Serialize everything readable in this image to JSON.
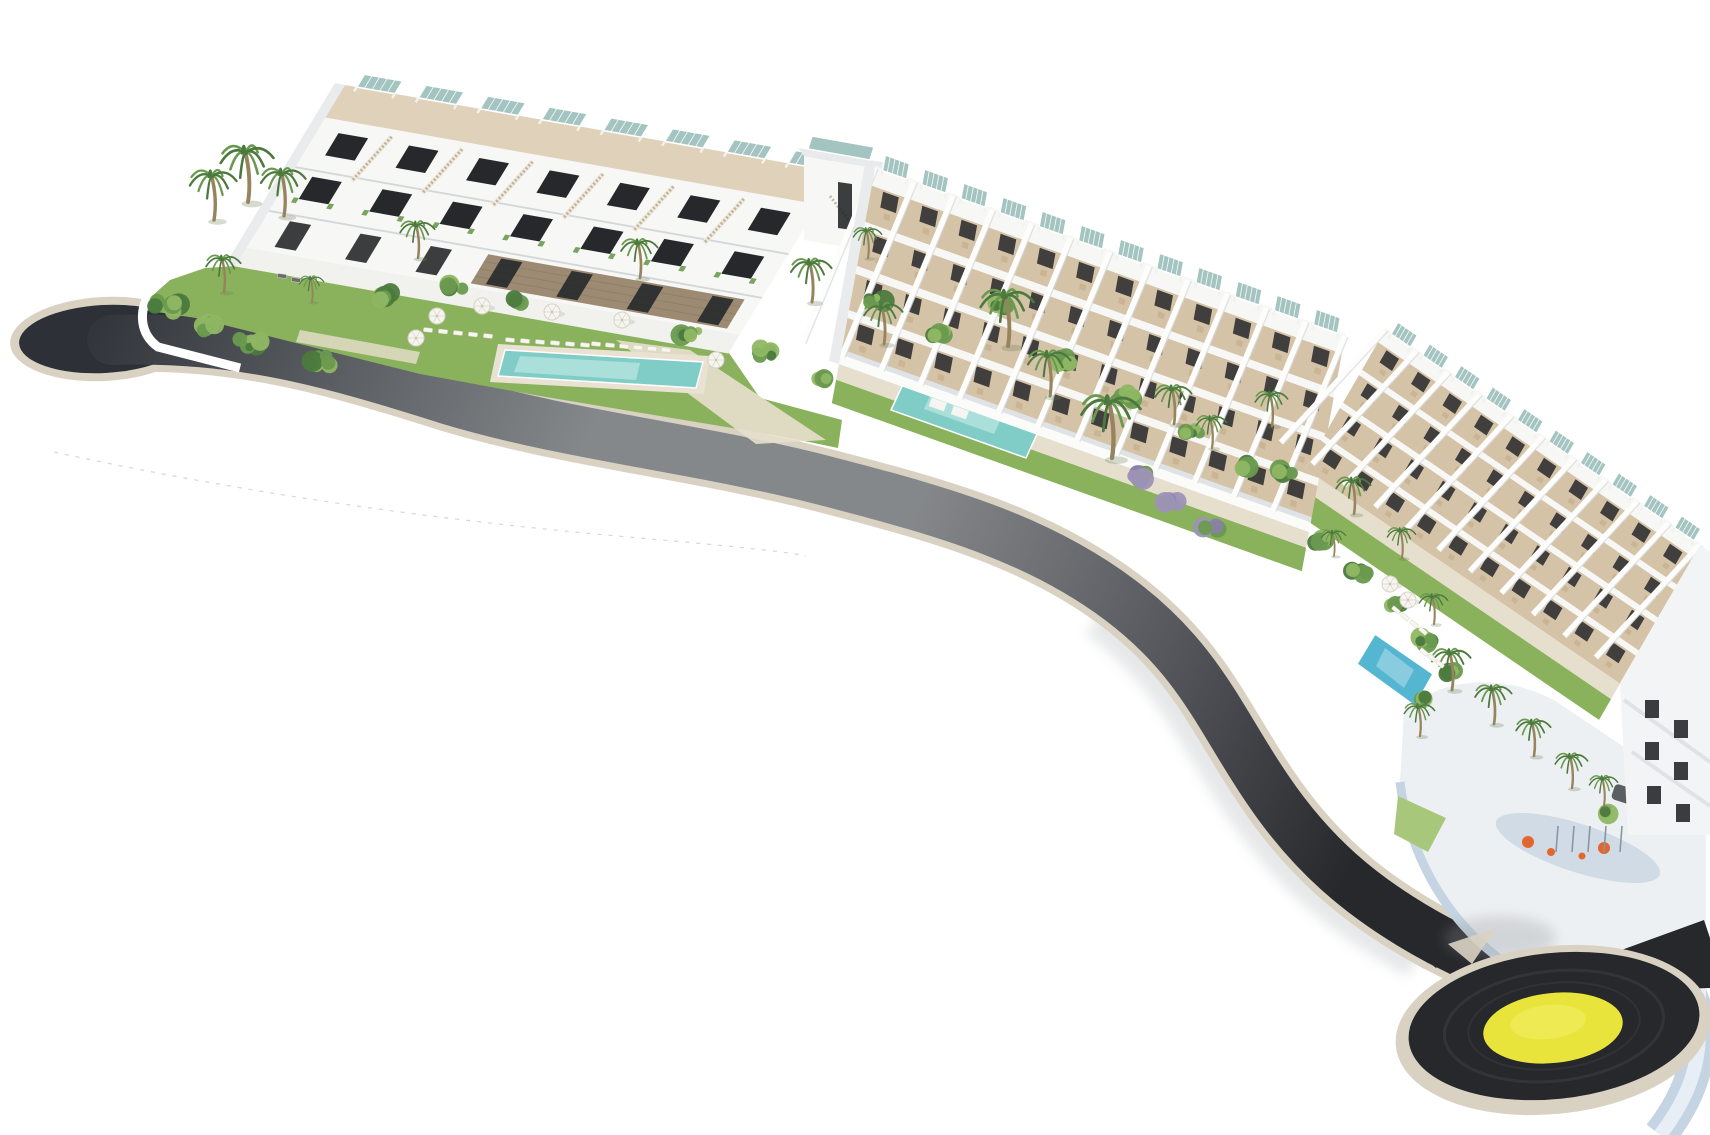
{
  "scene": {
    "type": "aerial-architectural-render",
    "subject": "terraced-white-apartment-complex-with-pools-palms-curved-road-and-roundabout",
    "background": "#ffffff"
  },
  "colors": {
    "background": "#ffffff",
    "road_asphalt_dark": "#2d3036",
    "road_asphalt_mid": "#85888b",
    "road_asphalt_deep": "#27282c",
    "road_curb": "#d9d2c3",
    "roundabout_yellow": "#e9e43c",
    "roundabout_yellow_light": "#f3ef67",
    "pool_turquoise": "#7fcdc6",
    "pool_turquoise_light": "#bde8e2",
    "pool_blue": "#55b6d2",
    "lawn": "#8ab25c",
    "lawn_light": "#a7c77a",
    "foliage_dark": "#4c7a3e",
    "foliage_mid": "#6a9a4f",
    "foliage_light": "#8fb763",
    "flower_purple": "#9d92b6",
    "building_white": "#f7f7f5",
    "building_shade": "#e2e4e6",
    "terrace_tan": "#d5c3a8",
    "terrace_tan_light": "#e0d2ba",
    "walkway_beige": "#e7dfcd",
    "window_dark": "#26282b",
    "solar_panel": "#a3c4c0",
    "stone_clad": "#9c8a72",
    "palm_trunk": "#96845f",
    "plaza_wall_blue": "#c5d4e2",
    "plaza_deck": "#ccd8e3",
    "playground_orange": "#e2672f"
  },
  "counts": {
    "residential_blocks": 3,
    "block_a_roof_pergolas": 8,
    "block_b_roof_pergolas": 12,
    "block_c_roof_pergolas": 10,
    "block_a_units": 7,
    "swimming_pools": 3,
    "roundabouts": 1,
    "palm_trees": 26,
    "sun_umbrellas": 8
  }
}
